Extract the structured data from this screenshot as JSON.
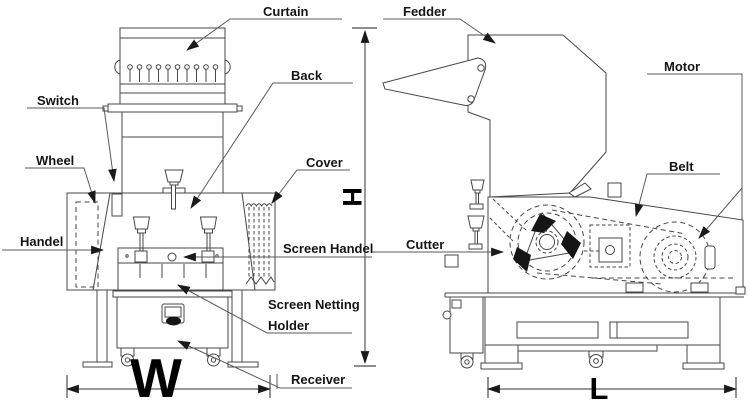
{
  "meta": {
    "background_color": "#ffffff",
    "line_color": "#474747",
    "label_color": "#151515",
    "arrow_color": "#1a1a1a"
  },
  "front_view": {
    "name": "granulator-front-view",
    "labels": {
      "curtain": "Curtain",
      "back": "Back",
      "switch": "Switch",
      "wheel": "Wheel",
      "cover": "Cover",
      "handel": "Handel",
      "screen_handel": "Screen Handel",
      "screen_netting": "Screen Netting",
      "holder": "Holder",
      "receiver": "Receiver"
    },
    "dimensions": {
      "width_letter": "W",
      "height_letter": "H"
    }
  },
  "side_view": {
    "name": "granulator-side-view",
    "labels": {
      "fedder": "Fedder",
      "motor": "Motor",
      "belt": "Belt",
      "cutter": "Cutter"
    },
    "dimensions": {
      "length_letter": "L"
    }
  }
}
